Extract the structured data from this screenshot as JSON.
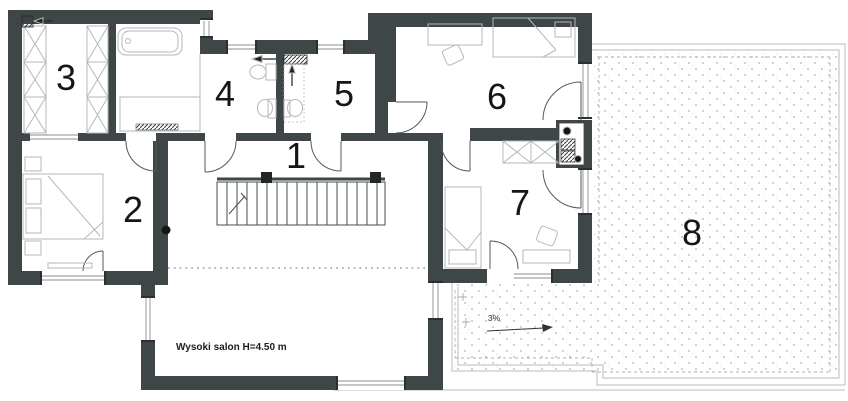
{
  "plan": {
    "rooms": [
      {
        "label": "1"
      },
      {
        "label": "2"
      },
      {
        "label": "3"
      },
      {
        "label": "4"
      },
      {
        "label": "5"
      },
      {
        "label": "6"
      },
      {
        "label": "7"
      },
      {
        "label": "8"
      }
    ],
    "annotations": {
      "salon_note": "Wysoki salon H=4.50 m",
      "slope": "3%"
    },
    "colors": {
      "wall": "#3f4648",
      "furniture": "#b5b9b9",
      "dots": "#b0b4b4",
      "outline": "#c6c9c9"
    }
  }
}
